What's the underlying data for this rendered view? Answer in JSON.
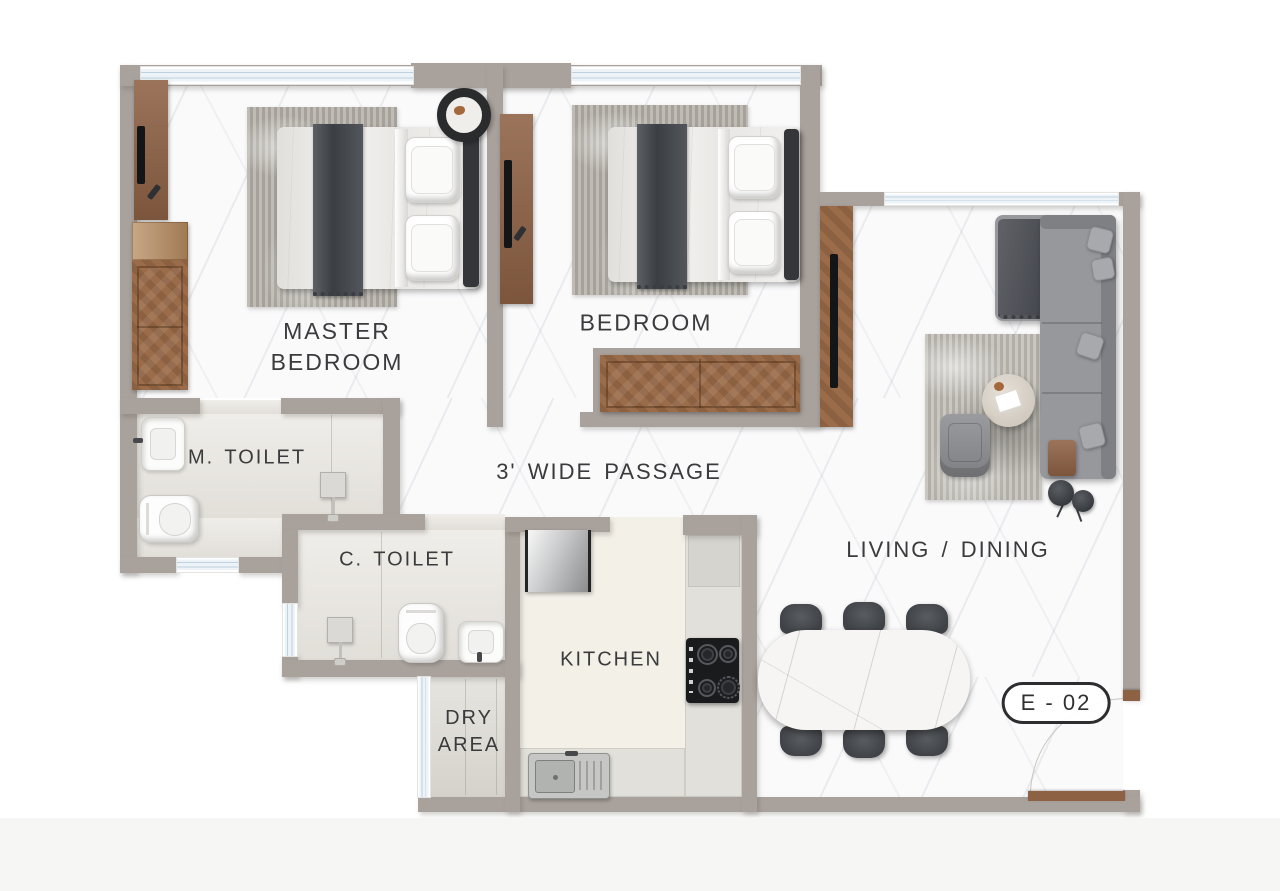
{
  "plan": {
    "unit_badge": "E - 02",
    "rooms": {
      "master_bedroom": {
        "label": "MASTER BEDROOM"
      },
      "bedroom": {
        "label": "BEDROOM"
      },
      "m_toilet": {
        "label": "M. TOILET"
      },
      "c_toilet": {
        "label": "C. TOILET"
      },
      "passage": {
        "label": "3' WIDE PASSAGE"
      },
      "kitchen": {
        "label": "KITCHEN"
      },
      "dry_area": {
        "label": "DRY AREA"
      },
      "living_dining": {
        "label": "LIVING / DINING"
      }
    },
    "colors": {
      "wall": "#a9a19b",
      "wood": "#9a6c4a",
      "wood_dark": "#8d6144",
      "tile": "#e9e6e0",
      "kitchen_floor": "#f3f0e8",
      "counter": "#e2e0da",
      "window_glass": "#bcd2e0",
      "sofa": "#97989c",
      "fabric_dark": "#4b4e53",
      "rug": "#b6b2aa",
      "chair": "#3f4246",
      "text": "#3b3b3d",
      "badge_border": "#2d2d2f"
    }
  }
}
